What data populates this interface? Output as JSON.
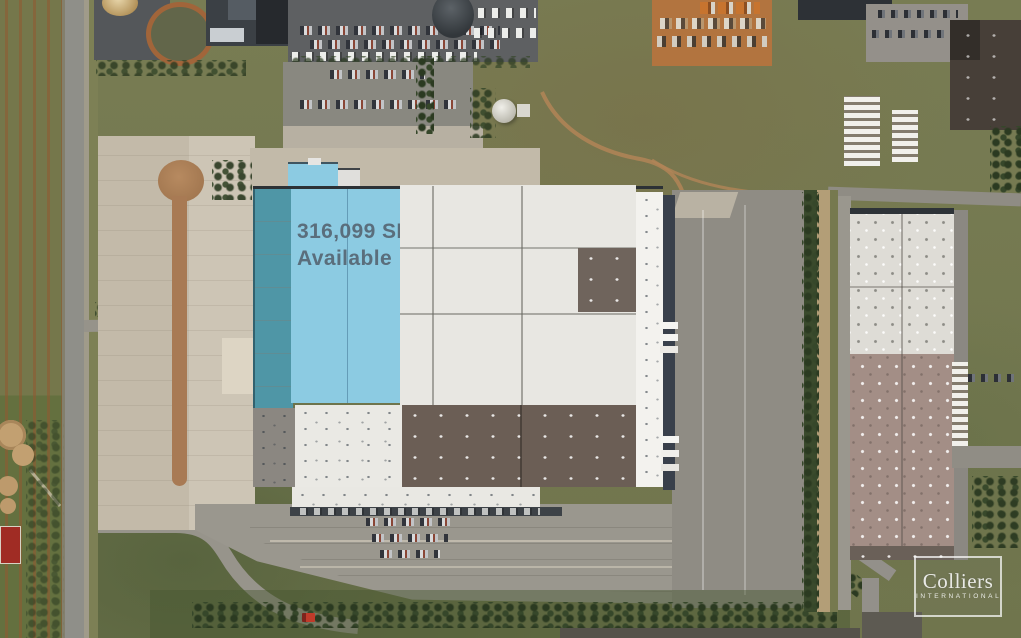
{
  "overlay": {
    "availability_label": {
      "line1": "316,099 SF",
      "line2": "Available"
    },
    "brand": {
      "line1": "Colliers",
      "line2": "INTERNATIONAL"
    }
  },
  "colors": {
    "highlight_fill": "#8ccbe2",
    "highlight_edge": "#4f96a6",
    "label_text": "#5a6e7c",
    "logo_text": "#ffffff",
    "roof_white": "#e8e7e2",
    "roof_dark_brown": "#6b5e55",
    "roof_gray": "#8b8781",
    "grass": "#75794f",
    "pavement": "#9a978e",
    "concrete_apron": "#c9c0b1",
    "dirt_orange": "#b2743f"
  }
}
